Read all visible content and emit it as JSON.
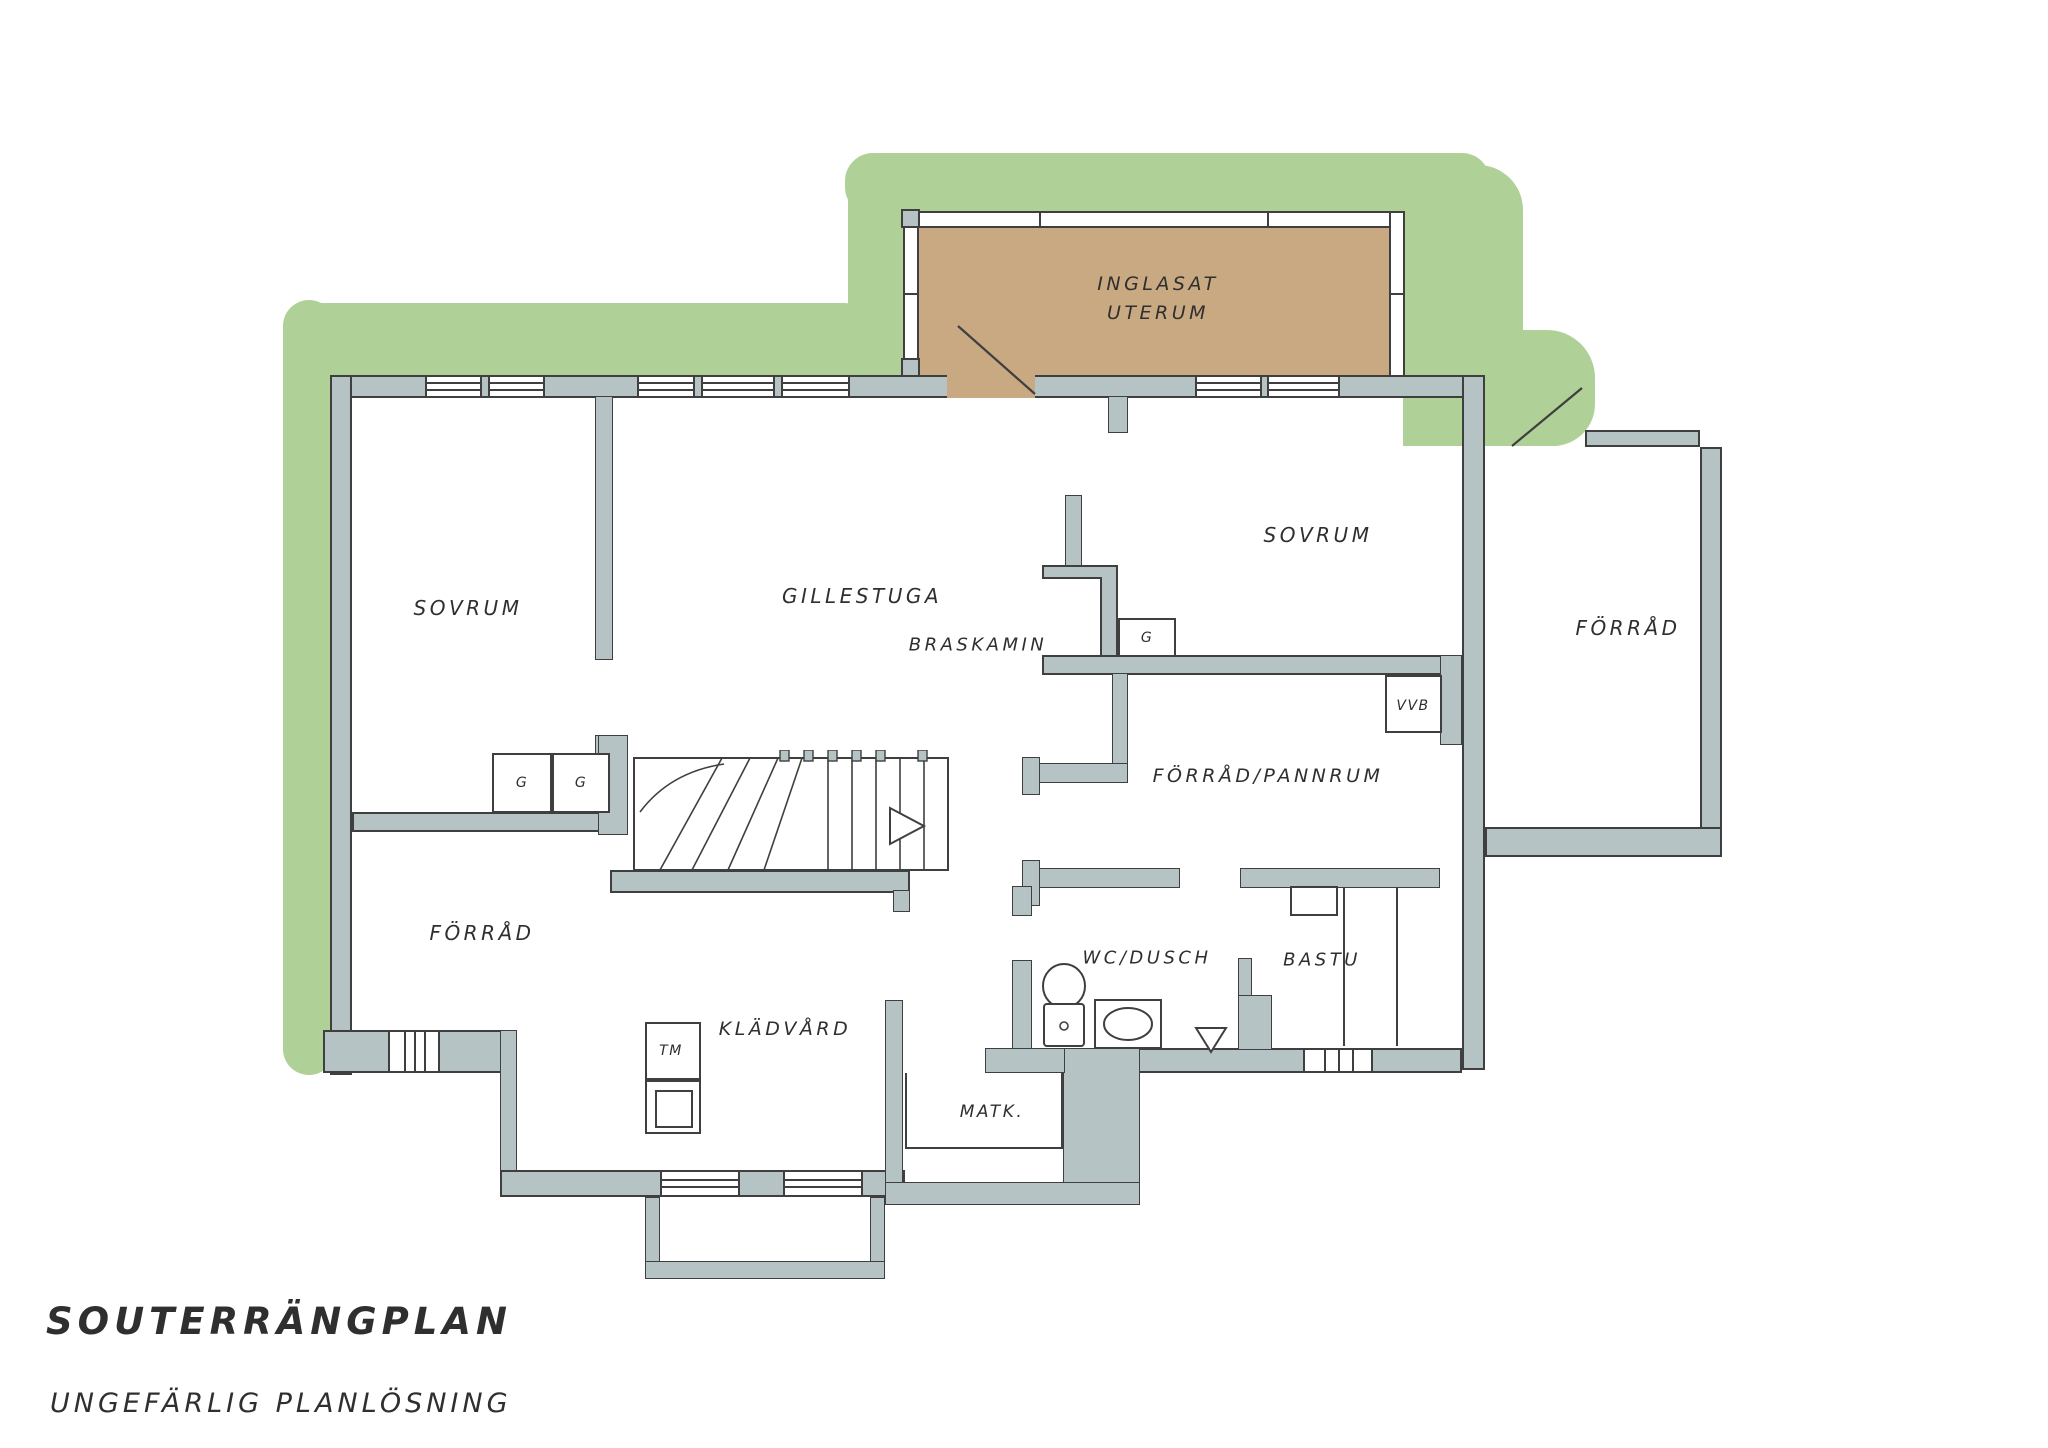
{
  "title": {
    "line1": "SOUTERRÄNGPLAN",
    "line2": "UNGEFÄRLIG PLANLÖSNING"
  },
  "colors": {
    "landscape_green": "#afd096",
    "wall_gray": "#b6c3c5",
    "uterum_tan": "#c9a981",
    "line_dark": "#3f3f3f",
    "text": "#2f2f2f",
    "background": "#ffffff"
  },
  "rooms": {
    "uterum": {
      "label_line1": "INGLASAT",
      "label_line2": "UTERUM"
    },
    "sovrum_left": {
      "label": "SOVRUM"
    },
    "gillestuga": {
      "label": "GILLESTUGA"
    },
    "braskamin": {
      "label": "BRASKAMIN"
    },
    "sovrum_right": {
      "label": "SOVRUM"
    },
    "forrad_right": {
      "label": "FÖRRÅD"
    },
    "vvb": {
      "label": "VVB"
    },
    "forrad_pannrum": {
      "label": "FÖRRÅD/PANNRUM"
    },
    "forrad_left": {
      "label": "FÖRRÅD"
    },
    "kladvard": {
      "label": "KLÄDVÅRD"
    },
    "tm": {
      "label": "TM"
    },
    "matk": {
      "label": "MATK."
    },
    "wc_dusch": {
      "label": "WC/DUSCH"
    },
    "bastu": {
      "label": "BASTU"
    },
    "wardrobe_g1": {
      "label": "G"
    },
    "wardrobe_g2": {
      "label": "G"
    },
    "wardrobe_g3": {
      "label": "G"
    }
  }
}
